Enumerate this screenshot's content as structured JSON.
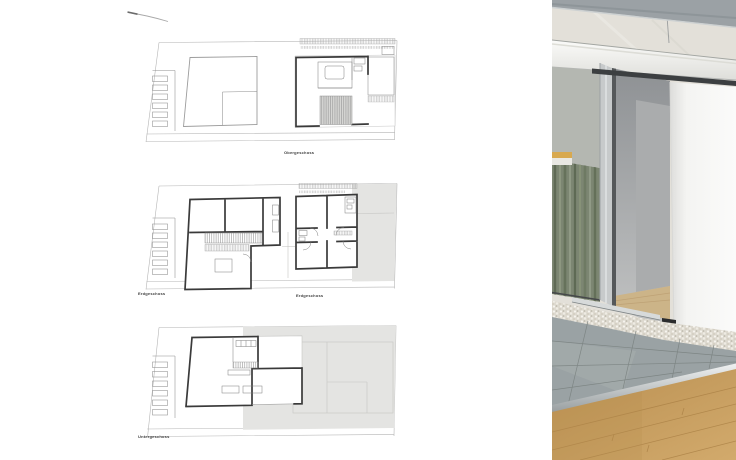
{
  "plans": {
    "labels": {
      "top": "Obergeschoss",
      "middle_left": "Erdgeschoss",
      "middle_right": "Erdgeschoss",
      "bottom": "Untergeschoss"
    }
  },
  "colors": {
    "page_bg": "#ffffff",
    "plan_wall": "#3a3a3a",
    "plan_thin_line": "#8f8f8f",
    "plan_site_line": "#b5b5b5",
    "plan_shaded_area": "#e4e4e2",
    "photo_roof_fascia": "#9ba1a5",
    "photo_white_beam": "#f7f7f4",
    "photo_sliding_panel": "#f2f2f0",
    "photo_glass": "#e3e0d9",
    "photo_bamboo_reflection": "#7c8672",
    "photo_terrace_tile": "#99a1a3",
    "photo_pebbles": "#e6e3da",
    "photo_wood_floor": "#c79e62"
  }
}
